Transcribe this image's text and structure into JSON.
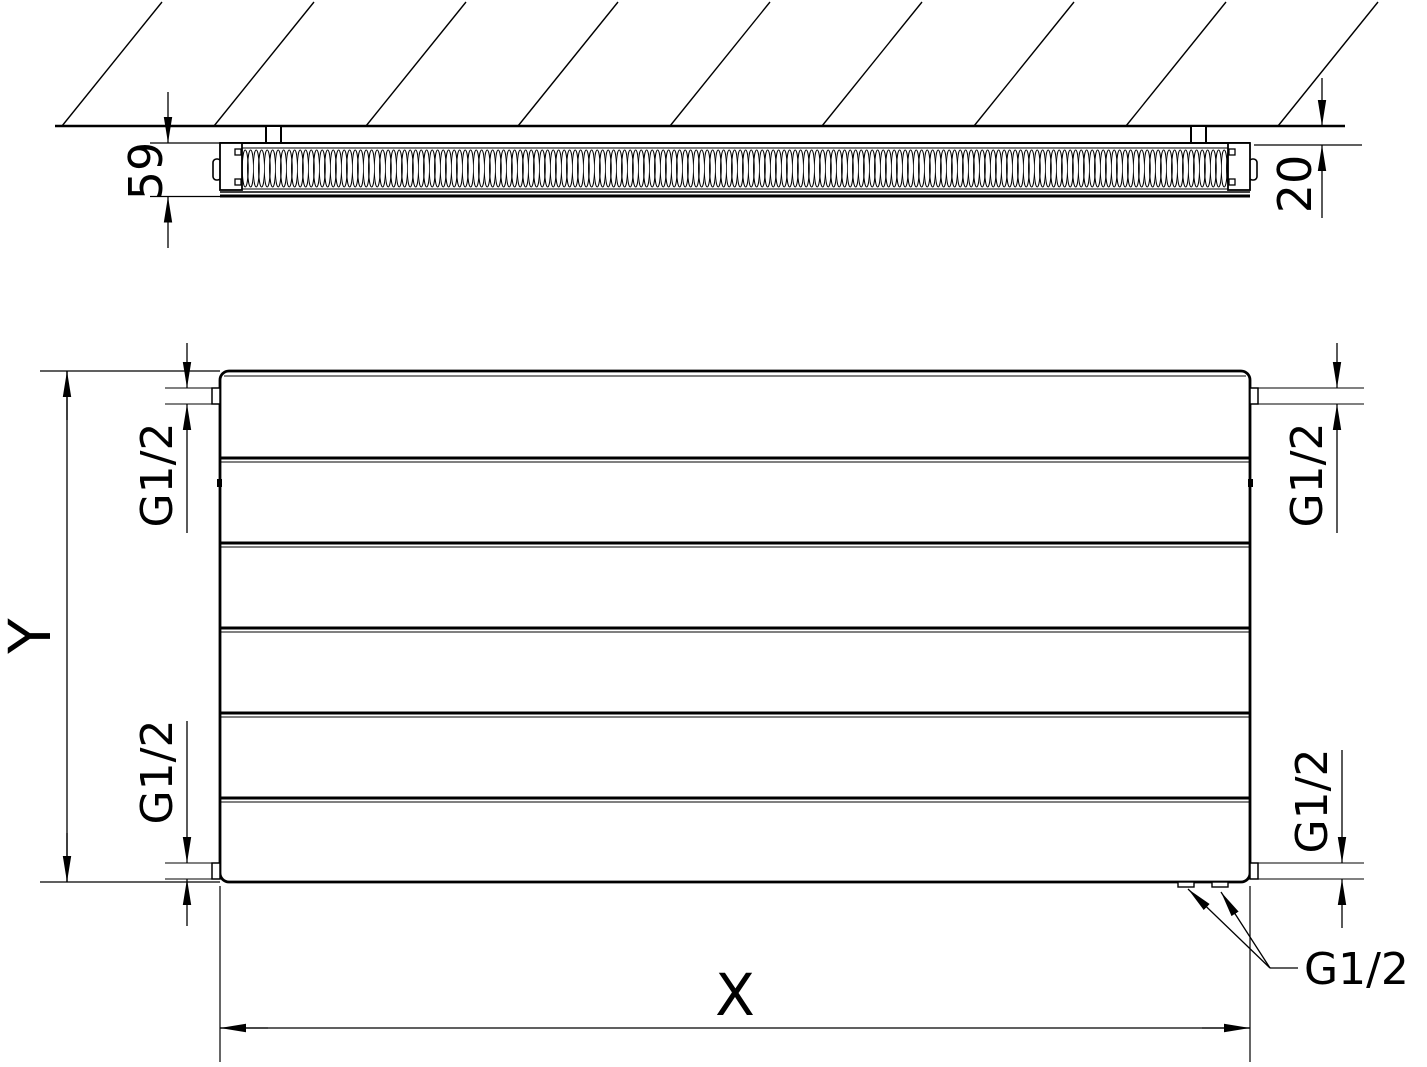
{
  "labels": {
    "section_view": {
      "depth": "59",
      "wall_distance": "20"
    },
    "front_view": {
      "height": "Y",
      "width": "X",
      "thread_top_left": "G1/2",
      "thread_bottom_left": "G1/2",
      "thread_top_right": "G1/2",
      "thread_bottom_right": "G1/2",
      "thread_bottom_connections": "G1/2"
    }
  },
  "colors": {
    "line": "#000000",
    "background": "#ffffff"
  }
}
